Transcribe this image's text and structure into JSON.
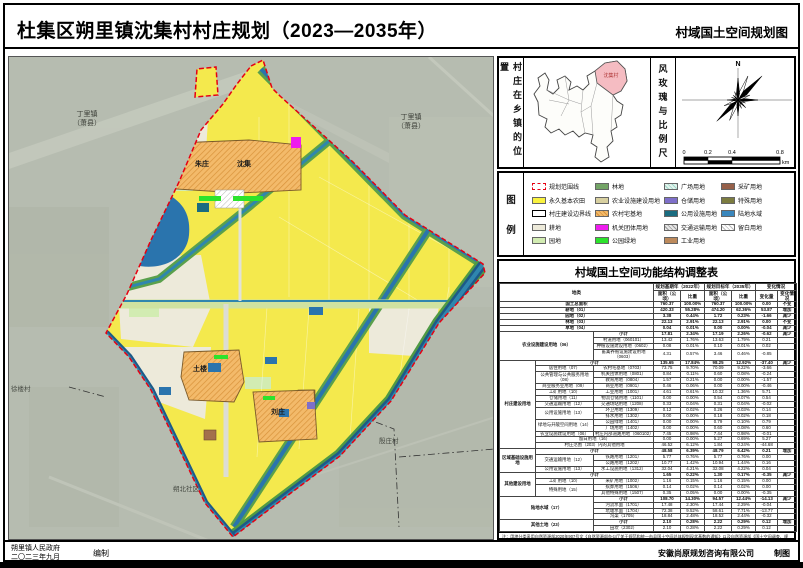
{
  "header": {
    "title": "杜集区朔里镇沈集村村庄规划（2023—2035年）",
    "map_title": "村域国土空间规划图"
  },
  "location_panel": {
    "label": "村庄在乡镇的位置",
    "highlight_label": "沈集村"
  },
  "windrose_panel": {
    "label": "风玫瑰与比例尺",
    "north_label": "N",
    "scale_ticks": [
      "0",
      "0.2",
      "0.4",
      "0.8"
    ],
    "scale_unit": "km"
  },
  "legend": {
    "label_chars": [
      "图",
      "例"
    ],
    "columns": [
      [
        {
          "label": "规划范围线",
          "type": "sw-dash-red"
        },
        {
          "label": "永久基本农田",
          "type": "sw-solid",
          "color": "#f9f23e"
        },
        {
          "label": "村庄建设边界线",
          "type": "sw-outline-black"
        },
        {
          "label": "耕地",
          "type": "sw-solid",
          "color": "#edeada"
        },
        {
          "label": "园地",
          "type": "sw-solid",
          "color": "#d2ecb2"
        }
      ],
      [
        {
          "label": "林地",
          "type": "sw-solid",
          "color": "#73a466"
        },
        {
          "label": "农业设施建设用地",
          "type": "sw-solid",
          "color": "#d8d0a0"
        },
        {
          "label": "农村宅基地",
          "type": "sw-hatch-orange"
        },
        {
          "label": "机关团体用地",
          "type": "sw-solid",
          "color": "#ee1dee"
        },
        {
          "label": "公园绿地",
          "type": "sw-solid",
          "color": "#2ce32c"
        }
      ],
      [
        {
          "label": "广场用地",
          "type": "sw-hatch-cyan"
        },
        {
          "label": "仓储用地",
          "type": "sw-solid",
          "color": "#7e6fc9"
        },
        {
          "label": "公用设施用地",
          "type": "sw-solid",
          "color": "#1a6c80"
        },
        {
          "label": "交通运输用地",
          "type": "sw-hatch-gray"
        },
        {
          "label": "工业用地",
          "type": "sw-solid",
          "color": "#bd8a5c"
        }
      ],
      [
        {
          "label": "采矿用地",
          "type": "sw-solid",
          "color": "#96604a"
        },
        {
          "label": "特殊用地",
          "type": "sw-solid",
          "color": "#7c7c40"
        },
        {
          "label": "陆地水域",
          "type": "sw-solid",
          "color": "#3a87bd"
        },
        {
          "label": "留白用地",
          "type": "sw-hatch-white"
        }
      ]
    ]
  },
  "map": {
    "labels": [
      {
        "t": "丁里镇\n（萧县）",
        "x": 64,
        "y": 54,
        "cls": "town"
      },
      {
        "t": "丁里镇\n（萧县）",
        "x": 388,
        "y": 57,
        "cls": "town"
      },
      {
        "t": "朱庄",
        "x": 186,
        "y": 104,
        "cls": "village"
      },
      {
        "t": "沈集",
        "x": 228,
        "y": 104,
        "cls": "village"
      },
      {
        "t": "土楼",
        "x": 184,
        "y": 309,
        "cls": "village"
      },
      {
        "t": "刘庄",
        "x": 262,
        "y": 352,
        "cls": "village"
      },
      {
        "t": "徐楼村",
        "x": 2,
        "y": 329,
        "cls": "outside"
      },
      {
        "t": "殷庄村",
        "x": 370,
        "y": 381,
        "cls": "outside"
      },
      {
        "t": "朔北社区",
        "x": 164,
        "y": 429,
        "cls": "outside"
      }
    ]
  },
  "table": {
    "title": "村域国土空间功能结构调整表",
    "header_rows": [
      [
        {
          "t": "地类",
          "cs": 3,
          "rs": 2
        },
        {
          "t": "规划基期年（2022年）",
          "cs": 2
        },
        {
          "t": "规划目标年（2035年）",
          "cs": 2
        },
        {
          "t": "变化情况",
          "cs": 2
        }
      ],
      [
        {
          "t": "面积（公顷）"
        },
        {
          "t": "比重"
        },
        {
          "t": "面积（公顷）"
        },
        {
          "t": "比重"
        },
        {
          "t": "变化量"
        },
        {
          "t": "变化情况"
        }
      ]
    ],
    "rows": [
      {
        "b": 1,
        "cells": [
          {
            "t": "国土总面积",
            "cs": 3
          },
          "760.37",
          "100.00%",
          "760.37",
          "100.00%",
          "0.00",
          "不变"
        ]
      },
      {
        "b": 1,
        "cells": [
          {
            "t": "耕地（01）",
            "cs": 3
          },
          "420.33",
          "55.28%",
          "474.20",
          "62.36%",
          "53.87",
          "增加"
        ]
      },
      {
        "b": 1,
        "cells": [
          {
            "t": "园地（02）",
            "cs": 3
          },
          "3.38",
          "0.44%",
          "1.72",
          "0.23%",
          "-1.66",
          "减少"
        ]
      },
      {
        "b": 1,
        "cells": [
          {
            "t": "林地（03）",
            "cs": 3
          },
          "22.13",
          "2.91%",
          "22.13",
          "2.91%",
          "0.00",
          "不变"
        ]
      },
      {
        "b": 1,
        "cells": [
          {
            "t": "草地（04）",
            "cs": 3
          },
          "0.04",
          "0.01%",
          "0.00",
          "0.00%",
          "-0.04",
          "减少"
        ]
      },
      {
        "b": 1,
        "cells": [
          {
            "t": "农业设施建设用地（06）",
            "cs": 2,
            "rs": 4
          },
          "小计",
          "17.81",
          "2.34%",
          "17.19",
          "2.26%",
          "-0.62",
          "减少"
        ]
      },
      {
        "cells": [
          "村道用地（060101）",
          "13.42",
          "1.76%",
          "13.63",
          "1.79%",
          "0.21",
          ""
        ]
      },
      {
        "cells": [
          "种植设施建设用地（0602）",
          "0.08",
          "0.01%",
          "0.10",
          "0.01%",
          "0.02",
          ""
        ]
      },
      {
        "cells": [
          "畜禽养殖设施建设用地（0603）",
          "4.31",
          "0.57%",
          "3.46",
          "0.46%",
          "-0.85",
          ""
        ]
      },
      {
        "b": 1,
        "cells": [
          {
            "t": "村庄建设用地",
            "rs": 15
          },
          {
            "t": "小计",
            "cs": 2
          },
          "135.65",
          "17.84%",
          "98.25",
          "12.92%",
          "-37.40",
          "减少"
        ]
      },
      {
        "cells": [
          "居住用地（07）",
          "农村宅基地（0703）",
          "73.75",
          "9.70%",
          "70.09",
          "9.22%",
          "-3.66",
          ""
        ]
      },
      {
        "cells": [
          {
            "t": "公共管理与公共服务用地（08）",
            "rs": 2
          },
          "机关团体用地（0801）",
          "0.84",
          "0.11%",
          "0.60",
          "0.08%",
          "-0.24",
          ""
        ]
      },
      {
        "cells": [
          "教育用地（0804）",
          "1.57",
          "0.21%",
          "0.00",
          "0.00%",
          "-1.57",
          ""
        ]
      },
      {
        "cells": [
          "商业服务业用地（09）",
          "商业用地（0901）",
          "0.46",
          "0.06%",
          "0.00",
          "0.00%",
          "-0.46",
          ""
        ]
      },
      {
        "cells": [
          "工矿用地（10）",
          "工业用地（1001）",
          "4.61",
          "0.61%",
          "10.32",
          "1.36%",
          "5.71",
          ""
        ]
      },
      {
        "cells": [
          "仓储用地（11）",
          "物流仓储用地（1101）",
          "0.00",
          "0.00%",
          "0.54",
          "0.07%",
          "0.54",
          ""
        ]
      },
      {
        "cells": [
          "交通运输用地（12）",
          "交通场站用地（1208）",
          "0.33",
          "0.04%",
          "0.31",
          "0.04%",
          "-0.02",
          ""
        ]
      },
      {
        "cells": [
          {
            "t": "公用设施用地（13）",
            "rs": 2
          },
          "环卫用地（1309）",
          "0.12",
          "0.02%",
          "0.26",
          "0.03%",
          "0.14",
          ""
        ]
      },
      {
        "cells": [
          "排水用地（1302）",
          "0.00",
          "0.00%",
          "0.18",
          "0.02%",
          "0.18",
          ""
        ]
      },
      {
        "cells": [
          {
            "t": "绿地与开敞空间用地（14）",
            "rs": 2
          },
          "公园绿地（1401）",
          "0.00",
          "0.00%",
          "0.79",
          "0.10%",
          "0.79",
          ""
        ]
      },
      {
        "cells": [
          "广场用地（1402）",
          "0.00",
          "0.00%",
          "0.60",
          "0.08%",
          "0.60",
          ""
        ]
      },
      {
        "cells": [
          "农业设施建设用地（06）",
          "村庄内部道路用地（060102）",
          "7.45",
          "0.98%",
          "7.44",
          "0.98%",
          "-0.01",
          ""
        ]
      },
      {
        "cells": [
          {
            "t": "留白用地（16）",
            "cs": 2
          },
          "0.00",
          "0.00%",
          "5.27",
          "0.69%",
          "5.27",
          ""
        ]
      },
      {
        "cells": [
          {
            "t": "村庄范围（203）内的其他用地",
            "cs": 2
          },
          "46.52",
          "6.12%",
          "1.84",
          "0.24%",
          "-44.68",
          ""
        ]
      },
      {
        "b": 1,
        "cells": [
          {
            "t": "区域基础设施用地",
            "rs": 4
          },
          {
            "t": "小计",
            "cs": 2
          },
          "48.58",
          "6.39%",
          "48.79",
          "6.42%",
          "0.21",
          "增加"
        ]
      },
      {
        "cells": [
          {
            "t": "交通运输用地（12）",
            "rs": 2
          },
          "铁路用地（1201）",
          "5.77",
          "0.76%",
          "5.77",
          "0.76%",
          "0.00",
          ""
        ]
      },
      {
        "cells": [
          "公路用地（1202）",
          "10.77",
          "1.42%",
          "10.94",
          "1.44%",
          "0.16",
          ""
        ]
      },
      {
        "cells": [
          "公用设施用地（13）",
          "水工设施用地（1312）",
          "32.04",
          "4.21%",
          "32.08",
          "4.22%",
          "0.04",
          ""
        ]
      },
      {
        "b": 1,
        "cells": [
          {
            "t": "其他建设用地",
            "rs": 4
          },
          {
            "t": "小计",
            "cs": 2
          },
          "1.65",
          "0.22%",
          "1.30",
          "0.17%",
          "-0.35",
          "减少"
        ]
      },
      {
        "cells": [
          "工矿用地（10）",
          "采矿用地（1002）",
          "1.16",
          "0.15%",
          "1.16",
          "0.15%",
          "0.00",
          ""
        ]
      },
      {
        "cells": [
          {
            "t": "特殊用地（15）",
            "rs": 2
          },
          "殡葬用地（1506）",
          "0.14",
          "0.02%",
          "0.14",
          "0.02%",
          "0.00",
          ""
        ]
      },
      {
        "cells": [
          "其他特殊用地（1507）",
          "0.35",
          "0.05%",
          "0.00",
          "0.00%",
          "-0.35",
          ""
        ]
      },
      {
        "b": 1,
        "cells": [
          {
            "t": "陆地水域（17）",
            "cs": 2,
            "rs": 4
          },
          "小计",
          "108.70",
          "14.30%",
          "94.57",
          "12.44%",
          "-14.13",
          "减少"
        ]
      },
      {
        "cells": [
          "河流水面（1701）",
          "17.48",
          "2.30%",
          "17.44",
          "2.29%",
          "-0.04",
          ""
        ]
      },
      {
        "cells": [
          "坑塘水面（1704）",
          "72.38",
          "9.52%",
          "58.61",
          "7.71%",
          "-13.77",
          ""
        ]
      },
      {
        "cells": [
          "沟渠（1705）",
          "18.84",
          "2.48%",
          "18.52",
          "2.44%",
          "-0.32",
          ""
        ]
      },
      {
        "b": 1,
        "cells": [
          {
            "t": "其他土地（23）",
            "cs": 2,
            "rs": 2
          },
          "小计",
          "2.10",
          "0.28%",
          "2.22",
          "0.29%",
          "0.12",
          "增加"
        ]
      },
      {
        "cells": [
          "田坎（2302）",
          "2.10",
          "0.28%",
          "2.22",
          "0.29%",
          "0.12",
          ""
        ]
      }
    ],
    "note": "注：用地分类采用自然资源部2020年907号文《自然资源部办公厅关于规范和统一市县国土空间总体规划现状基数的通知》以及自然资源部《国土空间调查、规划、用途管制用地用海分类指南》（试行）；制图标准参照《安徽省村庄规划编制指南（2022年版）》。"
  },
  "footer": {
    "government": "朔里镇人民政府",
    "date": "二〇二三年九月",
    "compile_label": "编制",
    "company": "安徽尚原规划咨询有限公司",
    "draw_label": "制图"
  },
  "colors": {
    "boundary_red": "#e60012",
    "farmland_yellow": "#f4e94d",
    "water_blue": "#2a74ad",
    "outside_gray": "#b6bcb0"
  }
}
